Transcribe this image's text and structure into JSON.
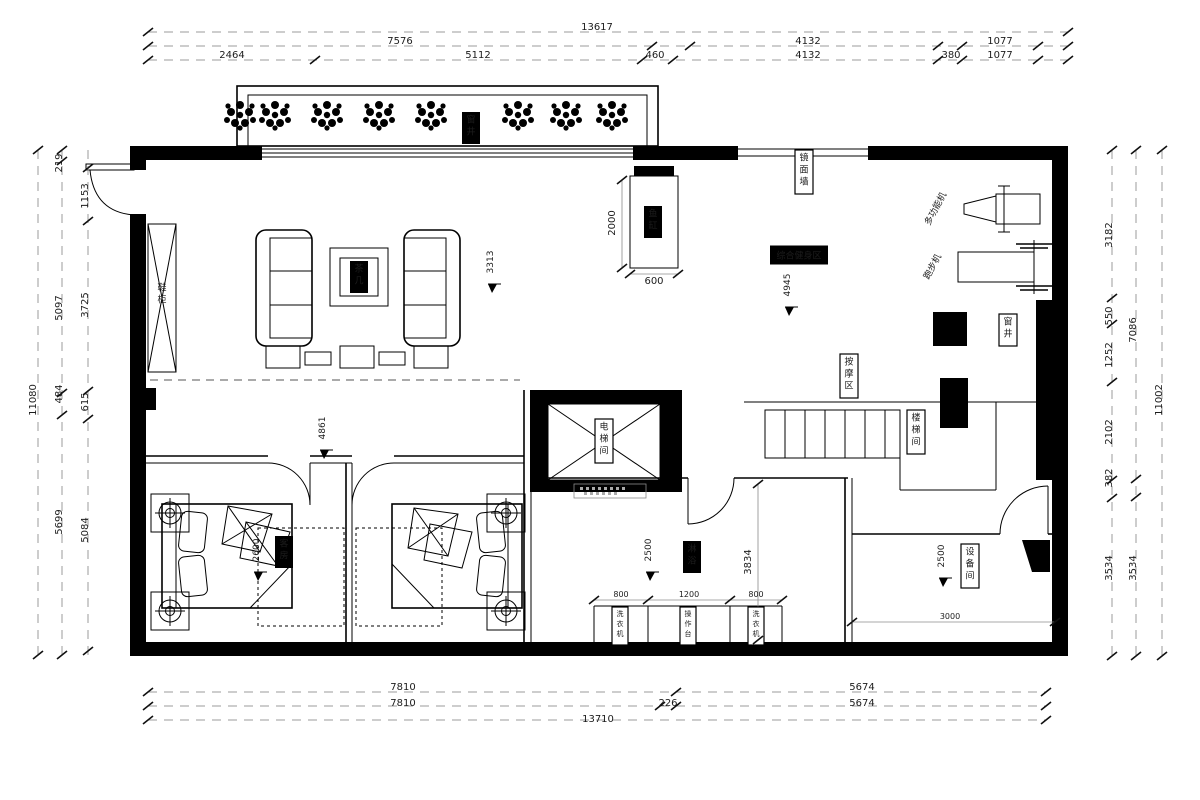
{
  "drawing": {
    "type": "residential-floor-plan",
    "units": "mm",
    "accent_color": "#000000",
    "dim_line_color": "#9b9b9b"
  },
  "annotations": [
    {
      "t": "13617",
      "x": 597,
      "y": 30,
      "s": "dim"
    },
    {
      "t": "7576",
      "x": 400,
      "y": 44,
      "s": "dim"
    },
    {
      "t": "4132",
      "x": 808,
      "y": 44,
      "s": "dim"
    },
    {
      "t": "1077",
      "x": 1000,
      "y": 44,
      "s": "dim"
    },
    {
      "t": "2464",
      "x": 232,
      "y": 58,
      "s": "dim"
    },
    {
      "t": "5112",
      "x": 478,
      "y": 58,
      "s": "dim"
    },
    {
      "t": "460",
      "x": 655,
      "y": 58,
      "s": "dim"
    },
    {
      "t": "4132",
      "x": 808,
      "y": 58,
      "s": "dim"
    },
    {
      "t": "380",
      "x": 951,
      "y": 58,
      "s": "dim"
    },
    {
      "t": "1077",
      "x": 1000,
      "y": 58,
      "s": "dim"
    },
    {
      "t": "7810",
      "x": 403,
      "y": 690,
      "s": "dim"
    },
    {
      "t": "5674",
      "x": 862,
      "y": 690,
      "s": "dim"
    },
    {
      "t": "7810",
      "x": 403,
      "y": 706,
      "s": "dim"
    },
    {
      "t": "226",
      "x": 668,
      "y": 706,
      "s": "dim"
    },
    {
      "t": "5674",
      "x": 862,
      "y": 706,
      "s": "dim"
    },
    {
      "t": "13710",
      "x": 598,
      "y": 722,
      "s": "dim"
    },
    {
      "t": "219",
      "x": 62,
      "y": 163,
      "s": "dim",
      "r": -90
    },
    {
      "t": "1153",
      "x": 88,
      "y": 196,
      "s": "dim",
      "r": -90
    },
    {
      "t": "5097",
      "x": 62,
      "y": 308,
      "s": "dim",
      "r": -90
    },
    {
      "t": "3725",
      "x": 88,
      "y": 305,
      "s": "dim",
      "r": -90
    },
    {
      "t": "615",
      "x": 88,
      "y": 402,
      "s": "dim",
      "r": -90
    },
    {
      "t": "484",
      "x": 62,
      "y": 394,
      "s": "dim",
      "r": -90
    },
    {
      "t": "5084",
      "x": 88,
      "y": 530,
      "s": "dim",
      "r": -90
    },
    {
      "t": "5699",
      "x": 62,
      "y": 522,
      "s": "dim",
      "r": -90
    },
    {
      "t": "11080",
      "x": 36,
      "y": 400,
      "s": "dim",
      "r": -90
    },
    {
      "t": "3182",
      "x": 1112,
      "y": 235,
      "s": "dim",
      "r": -90
    },
    {
      "t": "550",
      "x": 1112,
      "y": 316,
      "s": "dim",
      "r": -90
    },
    {
      "t": "1252",
      "x": 1112,
      "y": 355,
      "s": "dim",
      "r": -90
    },
    {
      "t": "2102",
      "x": 1112,
      "y": 432,
      "s": "dim",
      "r": -90
    },
    {
      "t": "382",
      "x": 1112,
      "y": 478,
      "s": "dim",
      "r": -90
    },
    {
      "t": "3534",
      "x": 1112,
      "y": 568,
      "s": "dim",
      "r": -90
    },
    {
      "t": "7086",
      "x": 1136,
      "y": 330,
      "s": "dim",
      "r": -90
    },
    {
      "t": "3534",
      "x": 1136,
      "y": 568,
      "s": "dim",
      "r": -90
    },
    {
      "t": "11002",
      "x": 1162,
      "y": 400,
      "s": "dim",
      "r": -90
    },
    {
      "t": "2000",
      "x": 615,
      "y": 223,
      "s": "dim",
      "r": -90
    },
    {
      "t": "600",
      "x": 654,
      "y": 284,
      "s": "dim"
    },
    {
      "t": "3834",
      "x": 751,
      "y": 562,
      "s": "dim",
      "r": -90
    },
    {
      "t": "800",
      "x": 621,
      "y": 597,
      "s": "dim",
      "fs": 8
    },
    {
      "t": "1200",
      "x": 689,
      "y": 597,
      "s": "dim",
      "fs": 8
    },
    {
      "t": "800",
      "x": 756,
      "y": 597,
      "s": "dim",
      "fs": 8
    },
    {
      "t": "3000",
      "x": 950,
      "y": 619,
      "s": "dim",
      "fs": 8
    },
    {
      "t": "3313",
      "x": 493,
      "y": 262,
      "s": "level"
    },
    {
      "t": "4945",
      "x": 790,
      "y": 285,
      "s": "level"
    },
    {
      "t": "4861",
      "x": 325,
      "y": 428,
      "s": "level"
    },
    {
      "t": "2600",
      "x": 259,
      "y": 550,
      "s": "level"
    },
    {
      "t": "2500",
      "x": 651,
      "y": 550,
      "s": "level"
    },
    {
      "t": "2500",
      "x": 944,
      "y": 556,
      "s": "level"
    },
    {
      "t": "窗井",
      "x": 471,
      "y": 128,
      "s": "boxb",
      "n": "label-lightwell-top"
    },
    {
      "t": "茶几",
      "x": 359,
      "y": 277,
      "s": "boxb",
      "n": "label-tea-table"
    },
    {
      "t": "鱼缸",
      "x": 653,
      "y": 222,
      "s": "boxb",
      "n": "label-fish-tank"
    },
    {
      "t": "淋浴",
      "x": 692,
      "y": 557,
      "s": "boxb",
      "n": "label-shower"
    },
    {
      "t": "客房",
      "x": 284,
      "y": 552,
      "s": "boxb",
      "n": "label-guest-room"
    },
    {
      "t": "综合健身区",
      "x": 799,
      "y": 255,
      "s": "hboxb",
      "n": "label-fitness-zone"
    },
    {
      "t": "窗井",
      "x": 1008,
      "y": 330,
      "s": "boxw",
      "n": "label-lightwell-right"
    },
    {
      "t": "镜面墙",
      "x": 804,
      "y": 172,
      "s": "boxw",
      "n": "label-mirror-wall"
    },
    {
      "t": "按摩区",
      "x": 849,
      "y": 376,
      "s": "boxw",
      "n": "label-massage-area"
    },
    {
      "t": "楼梯间",
      "x": 916,
      "y": 432,
      "s": "boxw",
      "n": "label-stair-room"
    },
    {
      "t": "电梯间",
      "x": 604,
      "y": 441,
      "s": "boxw",
      "n": "label-elevator-room"
    },
    {
      "t": "设备间",
      "x": 970,
      "y": 566,
      "s": "boxw",
      "n": "label-equipment-room"
    },
    {
      "t": "洗衣机",
      "x": 620,
      "y": 626,
      "s": "boxw",
      "fs": 7,
      "n": "label-washer-left"
    },
    {
      "t": "操作台",
      "x": 688,
      "y": 626,
      "s": "boxw",
      "fs": 7,
      "n": "label-worktop"
    },
    {
      "t": "洗衣机",
      "x": 756,
      "y": 626,
      "s": "boxw",
      "fs": 7,
      "n": "label-washer-right"
    },
    {
      "t": "鞋柜",
      "x": 162,
      "y": 296,
      "s": "vplain",
      "n": "label-shoe-cabinet"
    },
    {
      "t": "多功能机",
      "x": 938,
      "y": 210,
      "s": "rot",
      "r": -62,
      "n": "label-multi-gym"
    },
    {
      "t": "跑步机",
      "x": 935,
      "y": 268,
      "s": "rot",
      "r": -62,
      "n": "label-treadmill"
    }
  ]
}
